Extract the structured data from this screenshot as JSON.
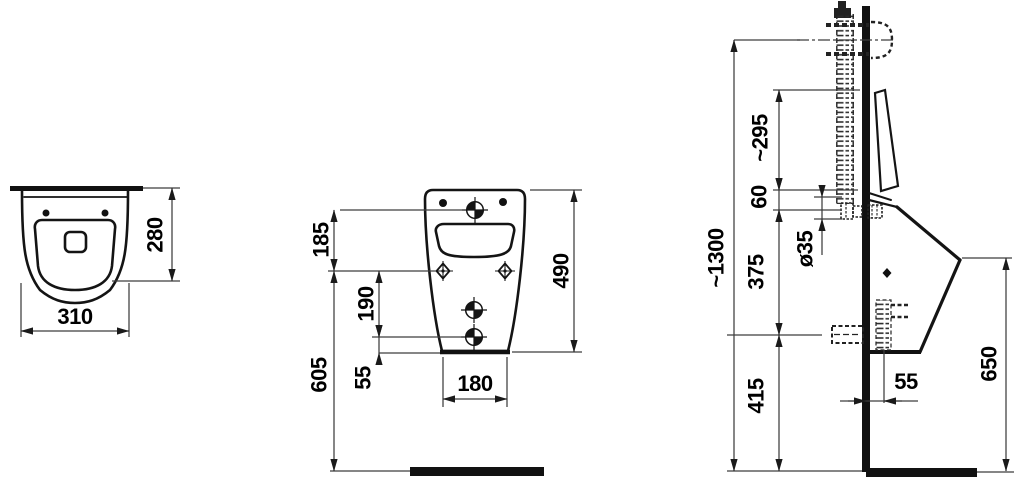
{
  "views": {
    "top": {
      "depth": "280",
      "width": "310"
    },
    "front": {
      "inlet_height_offset": "185",
      "hole_spacing": "190",
      "outlet_to_bottom": "55",
      "mount_height": "605",
      "drain_width": "180",
      "body_height": "490"
    },
    "side": {
      "supply_line_height": "~1300",
      "flush_pipe_length": "~295",
      "inlet_drop": "60",
      "pipe_diameter": "ø35",
      "inlet_to_outlet": "375",
      "outlet_height": "415",
      "front_height": "650",
      "outlet_offset": "55"
    }
  }
}
